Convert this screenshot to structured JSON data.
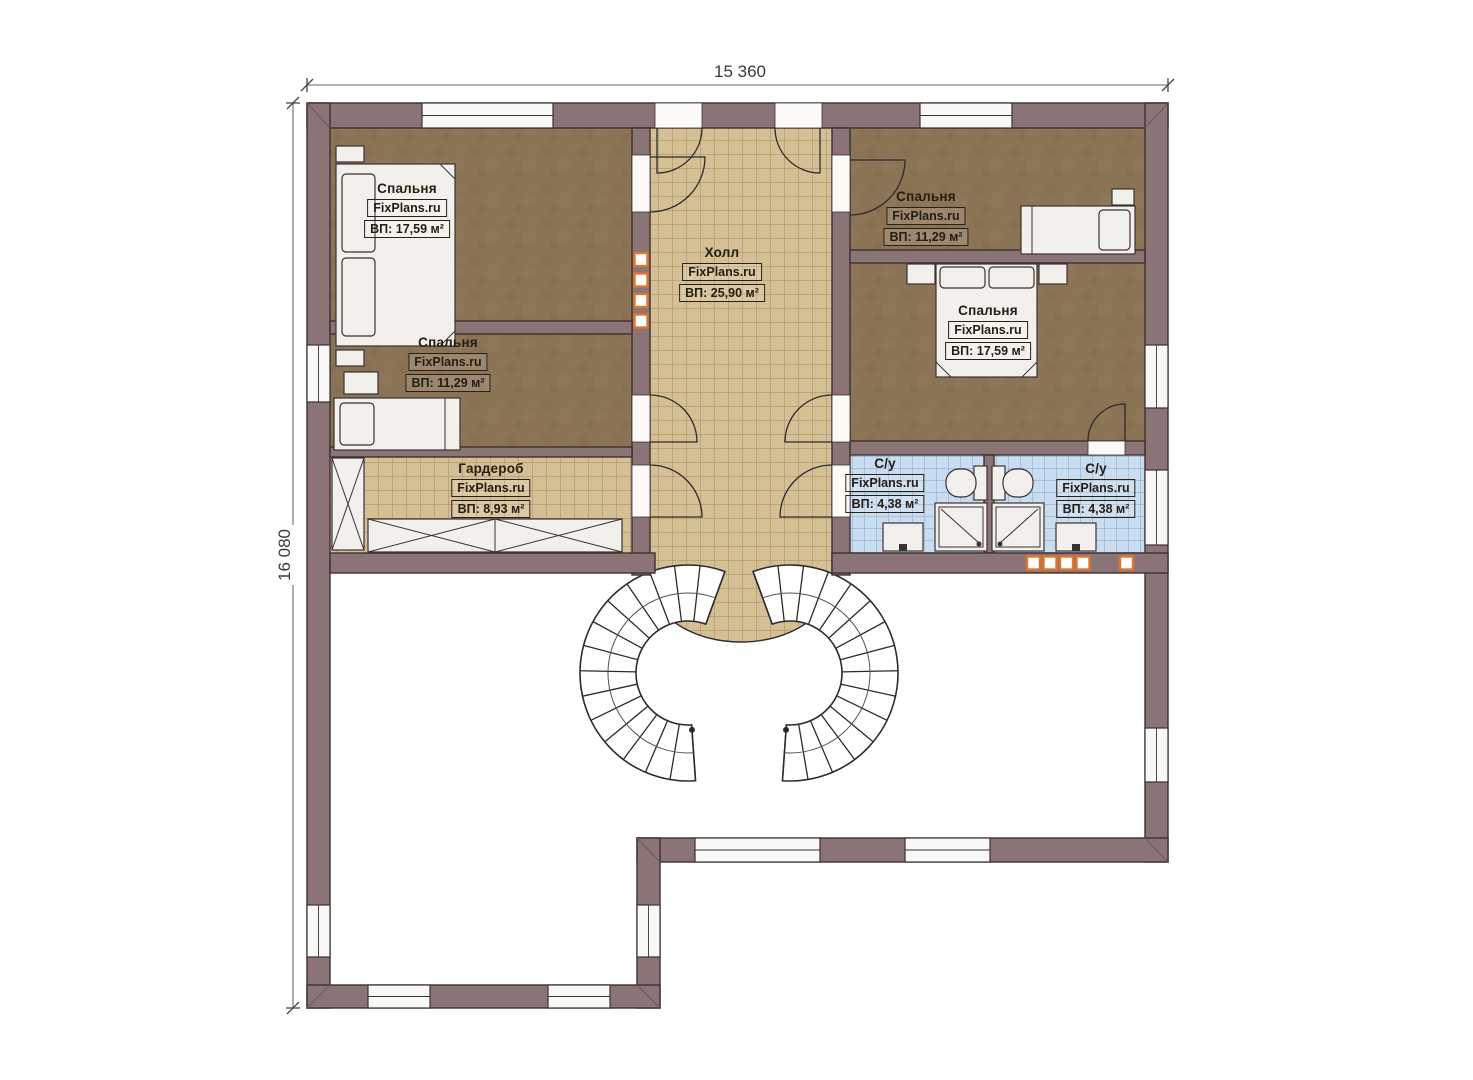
{
  "dimension_labels": {
    "width": "15 360",
    "height": "16 080"
  },
  "brand": "FixPlans.ru",
  "rooms": [
    {
      "key": "bedroom-top-left",
      "name": "Спальня",
      "brand": "FixPlans.ru",
      "area": "ВП: 17,59 м²"
    },
    {
      "key": "bedroom-mid-left",
      "name": "Спальня",
      "brand": "FixPlans.ru",
      "area": "ВП: 11,29 м²"
    },
    {
      "key": "hall",
      "name": "Холл",
      "brand": "FixPlans.ru",
      "area": "ВП: 25,90 м²"
    },
    {
      "key": "bedroom-top-right",
      "name": "Спальня",
      "brand": "FixPlans.ru",
      "area": "ВП: 11,29 м²"
    },
    {
      "key": "bedroom-right",
      "name": "Спальня",
      "brand": "FixPlans.ru",
      "area": "ВП: 17,59 м²"
    },
    {
      "key": "wardrobe",
      "name": "Гардероб",
      "brand": "FixPlans.ru",
      "area": "ВП: 8,93 м²"
    },
    {
      "key": "bathroom-left",
      "name": "С/у",
      "brand": "FixPlans.ru",
      "area": "ВП: 4,38 м²"
    },
    {
      "key": "bathroom-right",
      "name": "С/у",
      "brand": "FixPlans.ru",
      "area": "ВП: 4,38 м²"
    }
  ],
  "colors": {
    "wall": "#8a7476",
    "wall_outline": "#3c3133",
    "bedroom_floor": "#8b7355",
    "hall_tile": "#d5bf94",
    "hall_tile_line": "#a28b60",
    "bath_tile": "#c9dcf0",
    "bath_tile_line": "#7fa6cd",
    "accent_orange": "#e0762c"
  }
}
